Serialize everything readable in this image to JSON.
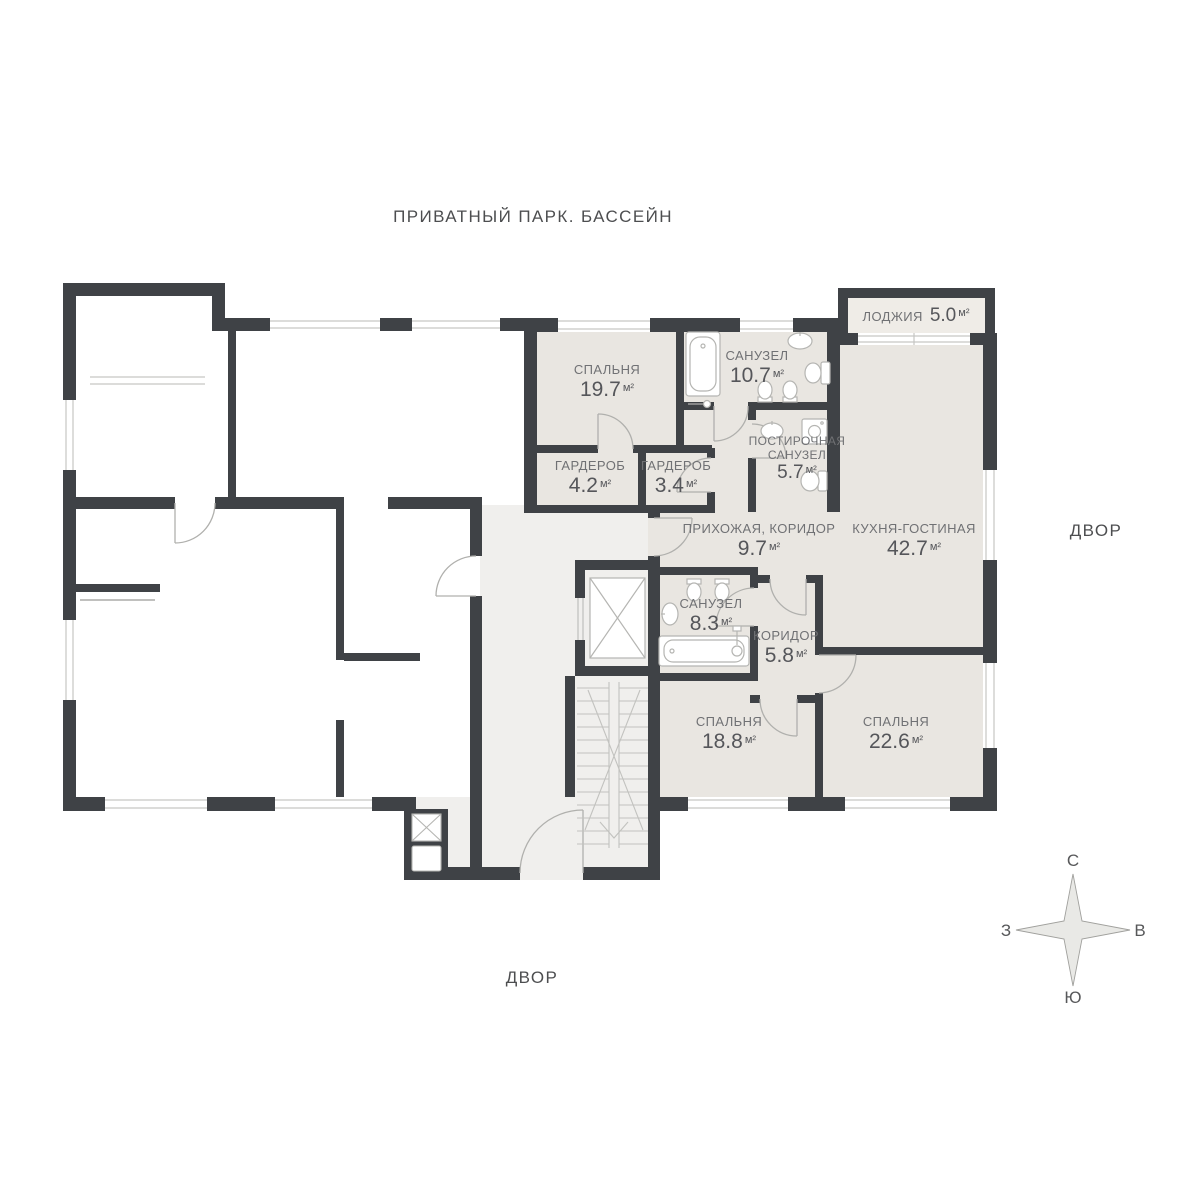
{
  "site_labels": {
    "top": "ПРИВАТНЫЙ ПАРК. БАССЕЙН",
    "right": "ДВОР",
    "bottom": "ДВОР"
  },
  "compass": {
    "north": "С",
    "east": "В",
    "south": "Ю",
    "west": "З"
  },
  "rooms": [
    {
      "id": "bedroom-1",
      "name": "СПАЛЬНЯ",
      "area": "19.7",
      "unit": "м²"
    },
    {
      "id": "bathroom-1",
      "name": "САНУЗЕЛ",
      "area": "10.7",
      "unit": "м²"
    },
    {
      "id": "loggia",
      "name": "ЛОДЖИЯ",
      "area": "5.0",
      "unit": "м²"
    },
    {
      "id": "wardrobe-1",
      "name": "ГАРДЕРОБ",
      "area": "4.2",
      "unit": "м²"
    },
    {
      "id": "wardrobe-2",
      "name": "ГАРДЕРОБ",
      "area": "3.4",
      "unit": "м²"
    },
    {
      "id": "laundry-bathroom",
      "name": "ПОСТИРОЧНАЯ САНУЗЕЛ",
      "area": "5.7",
      "unit": "м²"
    },
    {
      "id": "entry-hall",
      "name": "ПРИХОЖАЯ, КОРИДОР",
      "area": "9.7",
      "unit": "м²"
    },
    {
      "id": "kitchen-living",
      "name": "КУХНЯ-ГОСТИНАЯ",
      "area": "42.7",
      "unit": "м²"
    },
    {
      "id": "bathroom-2",
      "name": "САНУЗЕЛ",
      "area": "8.3",
      "unit": "м²"
    },
    {
      "id": "corridor",
      "name": "КОРИДОР",
      "area": "5.8",
      "unit": "м²"
    },
    {
      "id": "bedroom-2",
      "name": "СПАЛЬНЯ",
      "area": "18.8",
      "unit": "м²"
    },
    {
      "id": "bedroom-3",
      "name": "СПАЛЬНЯ",
      "area": "22.6",
      "unit": "м²"
    }
  ],
  "colors": {
    "wall": "#3f4246",
    "apartment_floor": "#e9e6e1",
    "loggia_floor": "#efece7",
    "common_floor": "#f0efed",
    "other_floor": "#ffffff",
    "fixture_stroke": "#b5b5b2",
    "window_line": "#c6c6c3",
    "label_text": "#707174",
    "number_text": "#55565a",
    "site_text": "#4d4e50"
  }
}
